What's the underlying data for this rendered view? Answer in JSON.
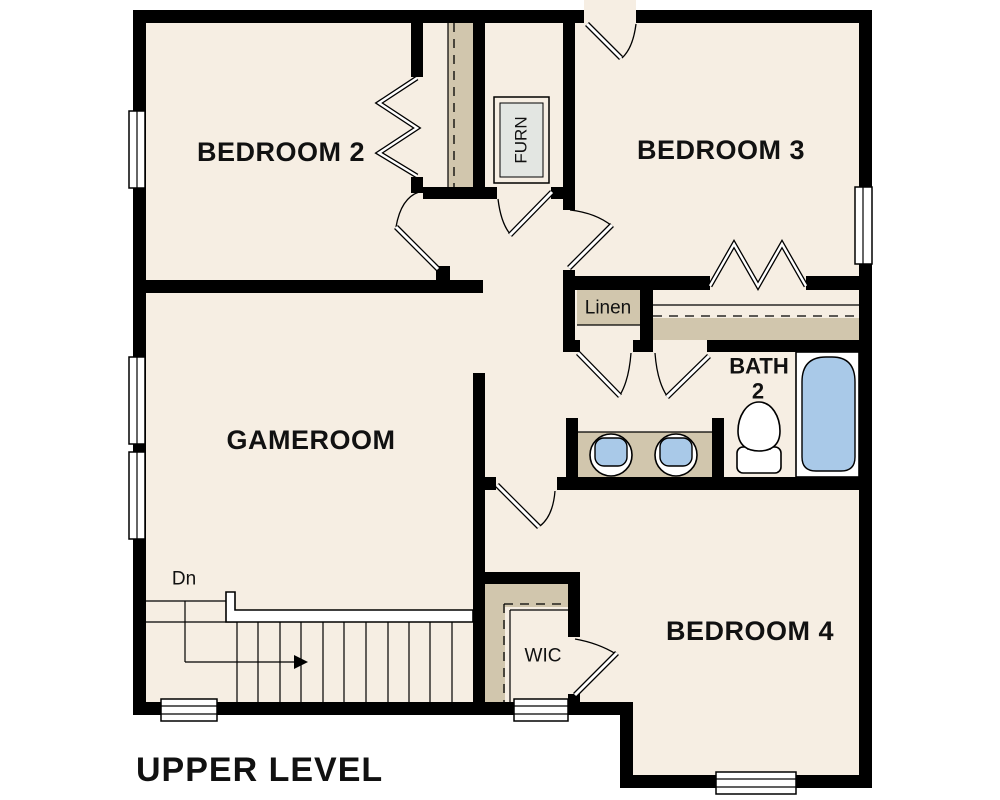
{
  "page_title": "UPPER LEVEL",
  "rooms": {
    "bedroom2": "BEDROOM 2",
    "bedroom3": "BEDROOM 3",
    "gameroom": "GAMEROOM",
    "bedroom4": "BEDROOM 4",
    "bath_name": "BATH",
    "bath_number": "2",
    "linen": "Linen",
    "wic": "WIC",
    "furnace": "FURN"
  },
  "stairs": {
    "direction_label": "Dn"
  },
  "colors": {
    "floor": "#f6eee3",
    "wall": "#000000",
    "shelf": "#d1c6ad",
    "fixture_blue": "#a9c9e8",
    "furnace_fill": "#e3e6e2",
    "outside": "#ffffff",
    "label_text": "#111111"
  }
}
